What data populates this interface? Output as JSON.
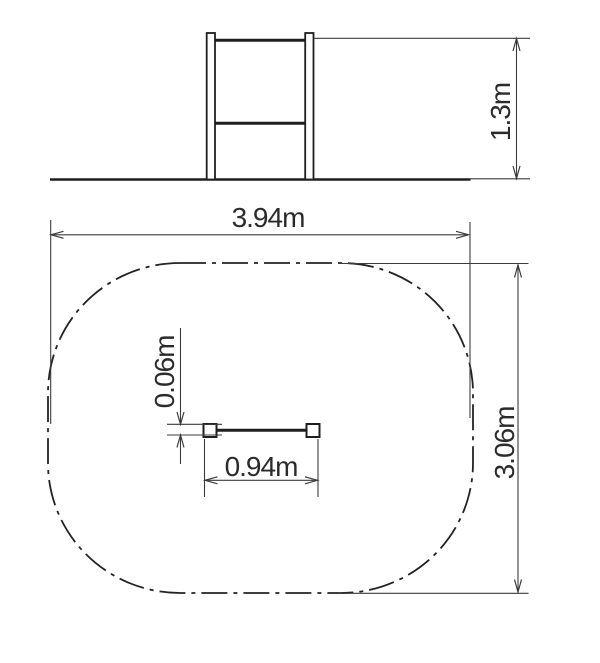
{
  "diagram": {
    "kind": "technical-drawing",
    "views": {
      "elevation": {
        "label_count": 1
      },
      "plan": {
        "label_count": 4
      }
    }
  },
  "dimensions": {
    "height": "1.3m",
    "zone_width": "3.94m",
    "zone_depth": "3.06m",
    "bar_length": "0.94m",
    "bar_offset": "0.06m"
  },
  "colors": {
    "background": "#ffffff",
    "object_line": "#1f1f1f",
    "dimension_line": "#3c3c3c",
    "zone_line": "#232323",
    "text": "#2b2b2b"
  }
}
